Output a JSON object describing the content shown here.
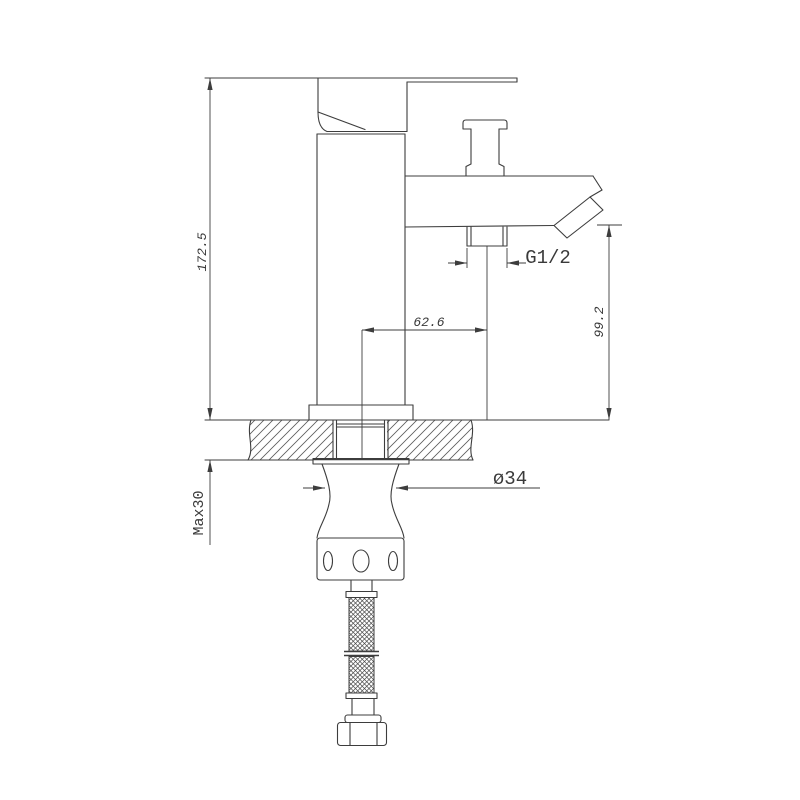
{
  "drawing": {
    "dimensions": {
      "overall_height": "172.5",
      "spout_offset": "62.6",
      "outlet_height": "99.2",
      "thread_size": "G1/2",
      "hole_diameter": "ø34",
      "max_deck_thickness": "Max30"
    },
    "colors": {
      "line": "#3d3d3d",
      "background": "#ffffff"
    }
  }
}
